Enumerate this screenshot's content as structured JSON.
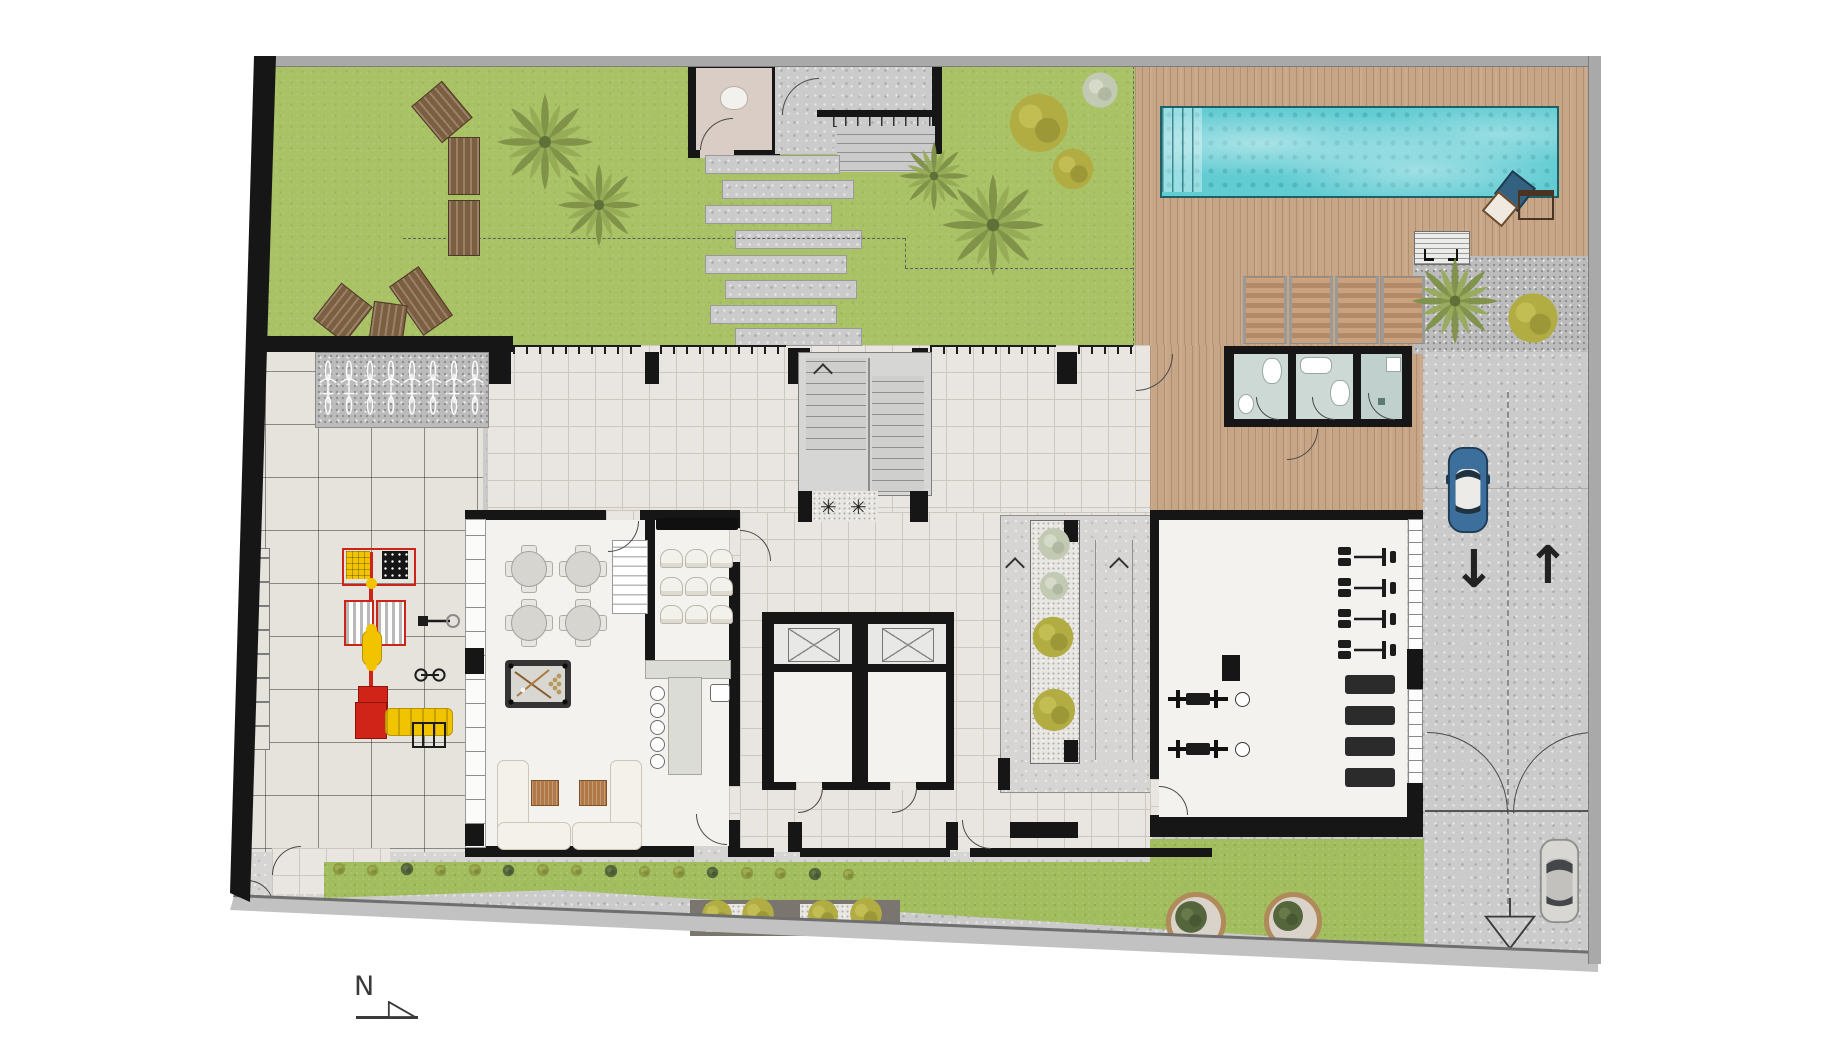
{
  "plan": {
    "type": "residential-ground-floor-site-plan",
    "north_label": "N",
    "traffic": {
      "down_arrow": "↓",
      "up_arrow": "↑"
    },
    "entry_mat_glyphs": [
      "✳",
      "✳"
    ],
    "palette": {
      "grass": "#a9c266",
      "wood_deck": "#c7a687",
      "pool_water": "#62ccd3",
      "pool_steps": "#9fe0e4",
      "tile": "#e9e5e0",
      "patio_tile": "#e6e2dc",
      "concrete": "#cbcbcb",
      "gravel": "#bcbcbc",
      "wall": "#161616",
      "bathroom_floor": "#cdd9d5",
      "shower_floor": "#bfd0cd",
      "restroom_floor": "#d9cdc6",
      "playground_red": "#d02418",
      "playground_yellow": "#f2c400",
      "car_blue": "#3d6f9c",
      "car_gray": "#d8d7d3",
      "sofa": "#f3f1ea",
      "coffee_table": "#b07947",
      "planter_ring": "#b08a5a"
    },
    "areas": [
      {
        "id": "lawn-northwest",
        "surface": "grass"
      },
      {
        "id": "entry-restroom",
        "surface": "interior"
      },
      {
        "id": "entry-court-stairs",
        "surface": "concrete"
      },
      {
        "id": "stepping-stone-path",
        "surface": "concrete"
      },
      {
        "id": "pool-deck",
        "surface": "wood"
      },
      {
        "id": "swimming-pool",
        "surface": "water"
      },
      {
        "id": "barbecue-corner",
        "surface": "wood"
      },
      {
        "id": "palm-planter-northeast",
        "surface": "gravel"
      },
      {
        "id": "pool-bathrooms",
        "surface": "interior"
      },
      {
        "id": "bicycle-parking",
        "surface": "gravel"
      },
      {
        "id": "playground-patio",
        "surface": "tile"
      },
      {
        "id": "clubhouse-games-lounge",
        "surface": "interior"
      },
      {
        "id": "cinema-bar",
        "surface": "interior"
      },
      {
        "id": "fire-stair",
        "surface": "concrete"
      },
      {
        "id": "elevator-core",
        "surface": "interior"
      },
      {
        "id": "access-ramp",
        "surface": "concrete"
      },
      {
        "id": "gym",
        "surface": "interior"
      },
      {
        "id": "driveway",
        "surface": "concrete"
      },
      {
        "id": "south-garden",
        "surface": "grass"
      },
      {
        "id": "sidewalk",
        "surface": "concrete"
      }
    ],
    "counts": {
      "wood_benches": 6,
      "bicycle_spots": 8,
      "sun_loungers": 4,
      "cafe_tables": 4,
      "cinema_seats": 9,
      "bar_stools": 5,
      "sofas": 2,
      "coffee_tables": 2,
      "elevators": 2,
      "restroom_cells": 3,
      "gym_strength_stations": 4,
      "gym_mats": 4,
      "gym_bench_press": 2,
      "cars": 2,
      "pools": 1,
      "driveway_lanes": 2
    }
  }
}
